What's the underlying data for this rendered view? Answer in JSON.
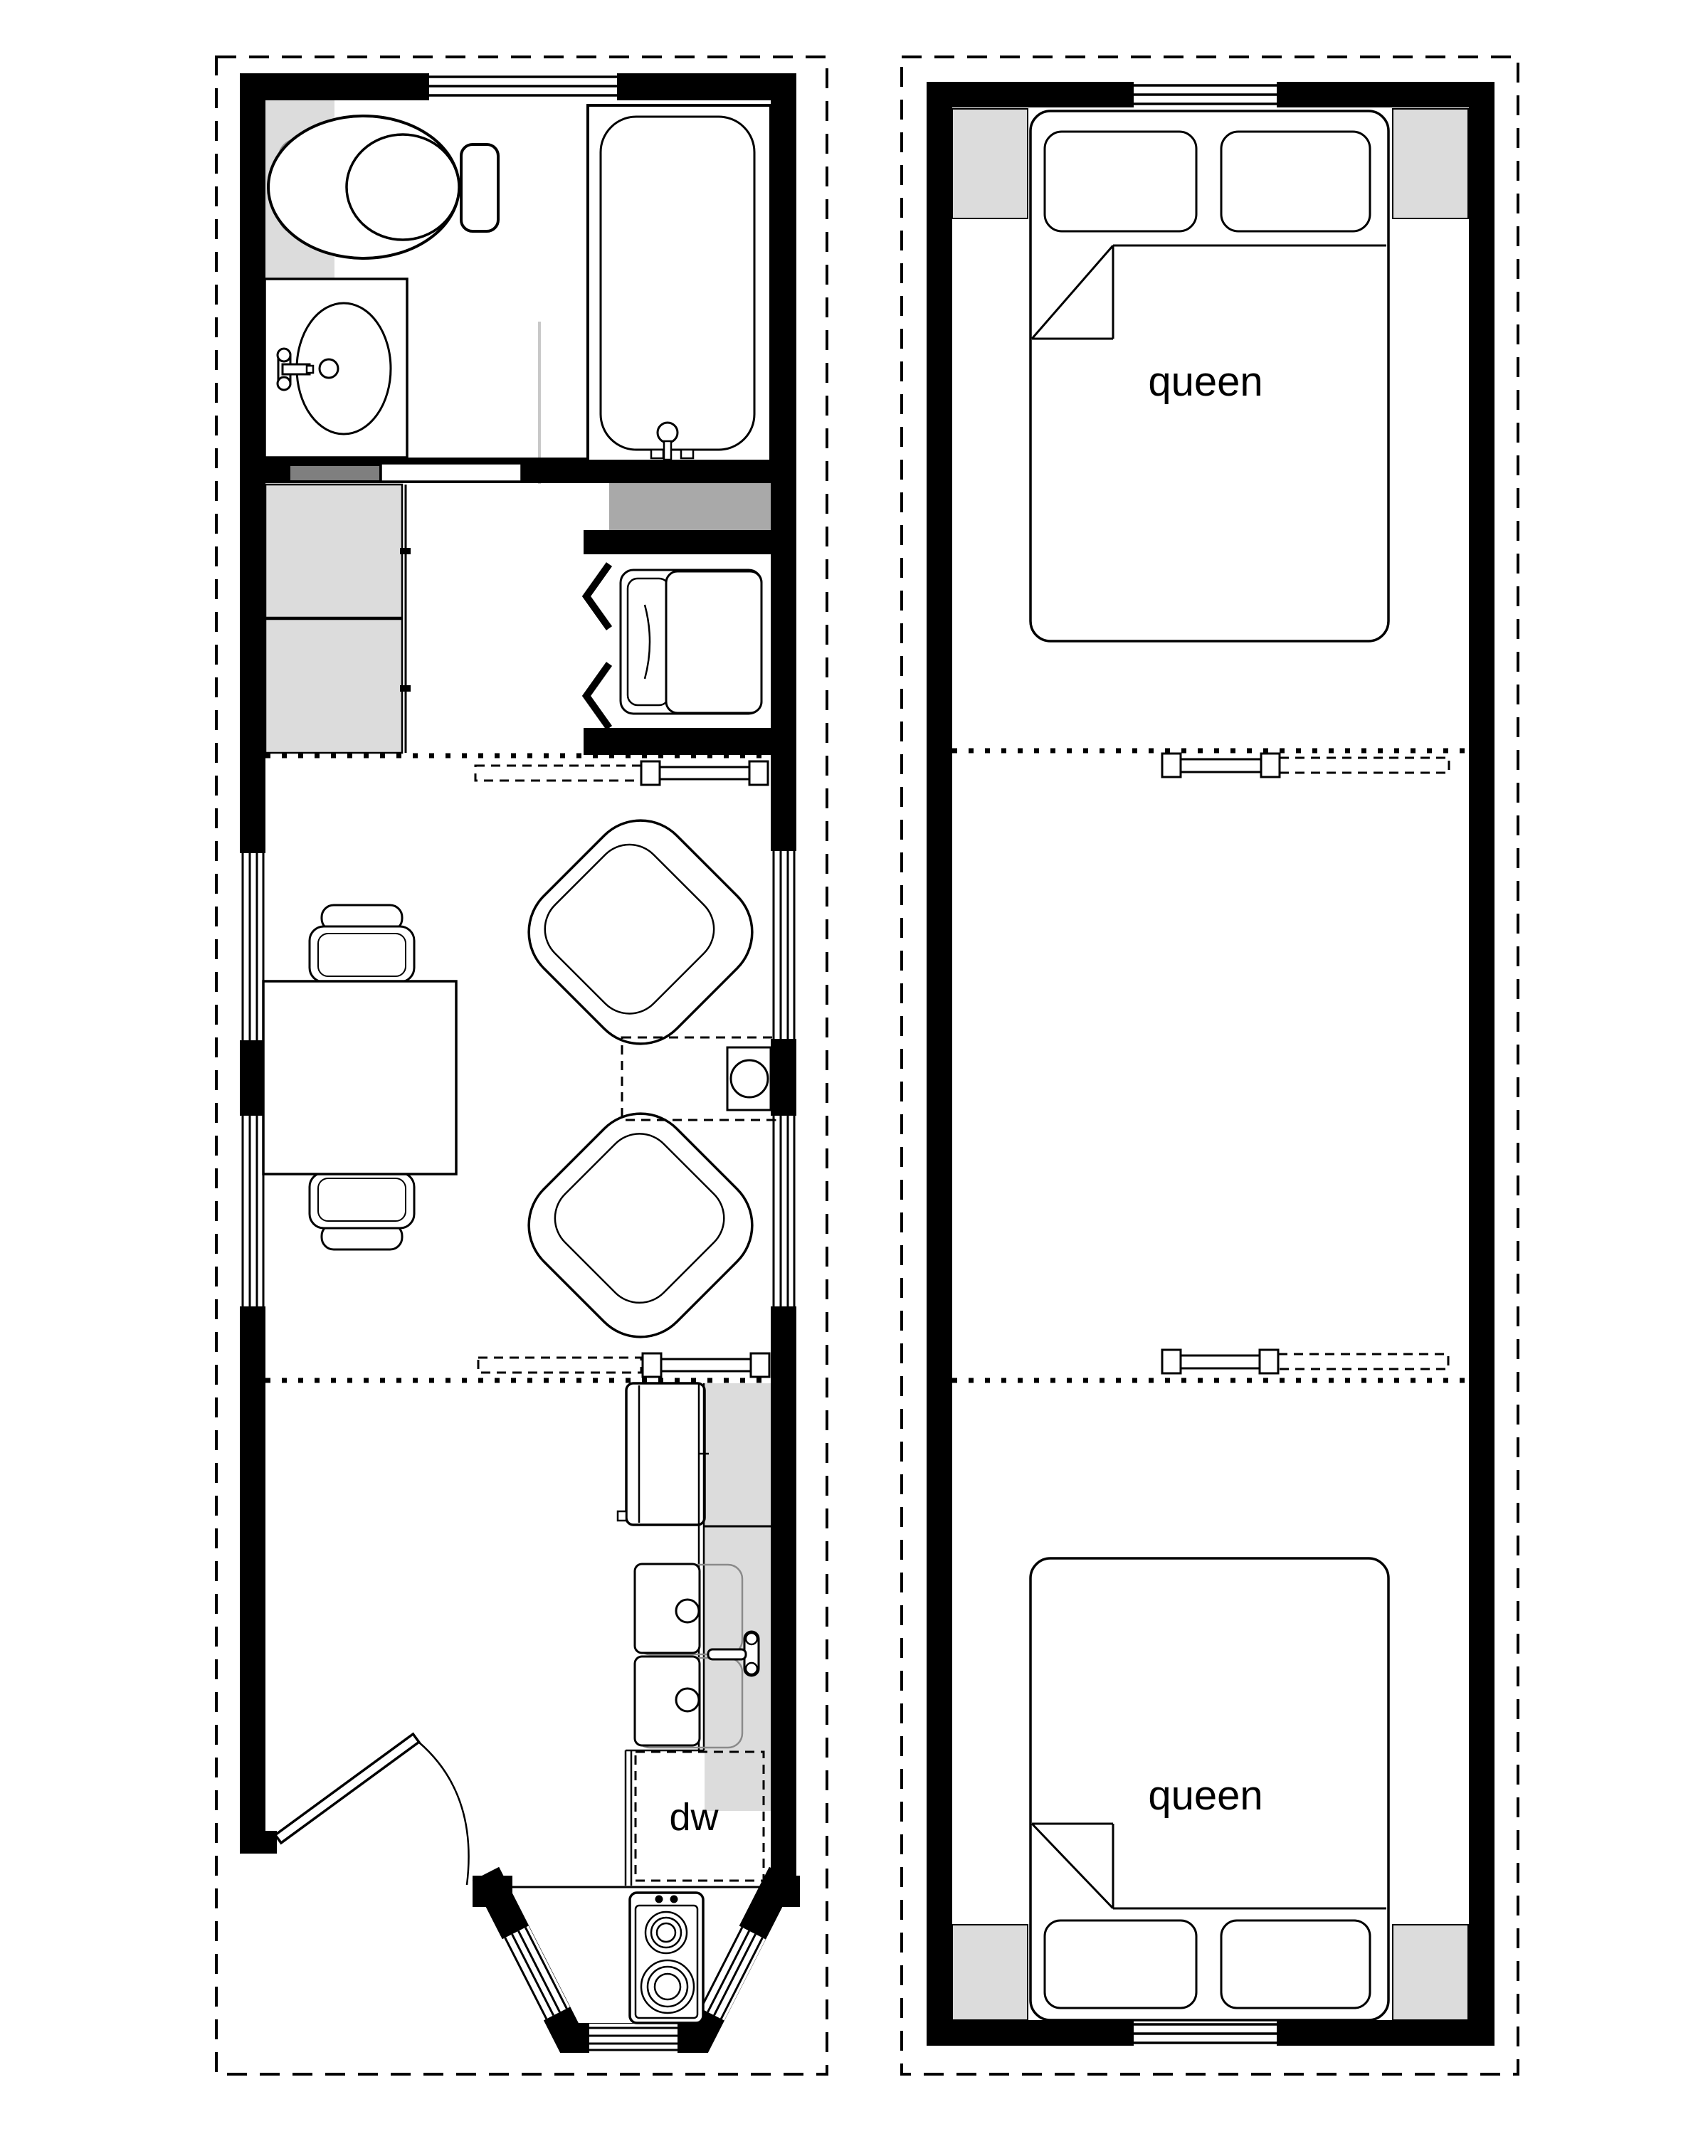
{
  "colors": {
    "paper": "#ffffff",
    "ink": "#000000",
    "light_gray": "#dcdcdc",
    "mid_gray": "#a9a9a9",
    "dark_gray": "#7f7f7f",
    "gray_line": "#8a8a8a",
    "pale_line": "#c8c8c8"
  },
  "main_floor": {
    "dishwasher_label": "dw",
    "rooms": [
      "bathroom",
      "hallway",
      "living-area",
      "kitchen",
      "entry-bay"
    ],
    "fixtures": [
      "toilet",
      "shower-pan",
      "vanity-sink",
      "bathtub",
      "pocket-door",
      "storage-cabinets",
      "laundry-counter",
      "washer-dryer",
      "bifold-doors",
      "dining-table",
      "dining-chairs",
      "lounge-chairs",
      "side-table-with-lamp",
      "refrigerator",
      "kitchen-counter",
      "double-basin-sink",
      "dishwasher",
      "entry-door",
      "cooktop",
      "loft-ladder",
      "loft-edge"
    ]
  },
  "loft": {
    "beds": [
      {
        "label": "queen"
      },
      {
        "label": "queen"
      }
    ],
    "fixtures": [
      "storage-cubbies",
      "open-to-below",
      "loft-ladder",
      "windows"
    ]
  }
}
